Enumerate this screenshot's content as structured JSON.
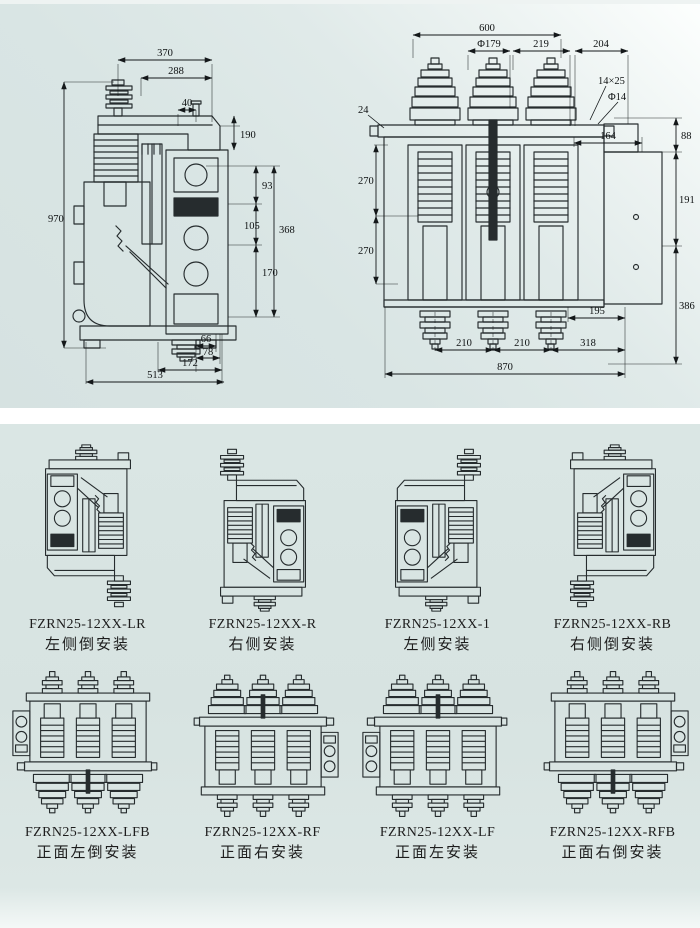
{
  "colors": {
    "background_top": "#dce7e6",
    "background_bottom": "#d8e4e2",
    "divider": "#ffffff",
    "line": "#262c2e"
  },
  "left_drawing": {
    "name": "side-view-dimension-drawing",
    "dims": {
      "d370": "370",
      "d288": "288",
      "d190": "190",
      "d40": "40",
      "d970": "970",
      "d93": "93",
      "d105": "105",
      "d368": "368",
      "d170": "170",
      "d66": "66",
      "d78": "78",
      "d172": "172",
      "d513": "513"
    }
  },
  "right_drawing": {
    "name": "front-view-dimension-drawing",
    "dims": {
      "d600": "600",
      "dia179": "Φ179",
      "d219": "219",
      "d204": "204",
      "slot": "14×25",
      "dia14": "Φ14",
      "d24": "24",
      "d164": "164",
      "d88": "88",
      "d191": "191",
      "d270a": "270",
      "d270b": "270",
      "d386": "386",
      "d195": "195",
      "d210a": "210",
      "d210b": "210",
      "d318": "318",
      "d870": "870"
    }
  },
  "variants": [
    {
      "model": "FZRN25-12XX-LR",
      "desc": "左侧倒安装"
    },
    {
      "model": "FZRN25-12XX-R",
      "desc": "右侧安装"
    },
    {
      "model": "FZRN25-12XX-1",
      "desc": "左侧安装"
    },
    {
      "model": "FZRN25-12XX-RB",
      "desc": "右侧倒安装"
    },
    {
      "model": "FZRN25-12XX-LFB",
      "desc": "正面左倒安装"
    },
    {
      "model": "FZRN25-12XX-RF",
      "desc": "正面右安装"
    },
    {
      "model": "FZRN25-12XX-LF",
      "desc": "正面左安装"
    },
    {
      "model": "FZRN25-12XX-RFB",
      "desc": "正面右倒安装"
    }
  ]
}
